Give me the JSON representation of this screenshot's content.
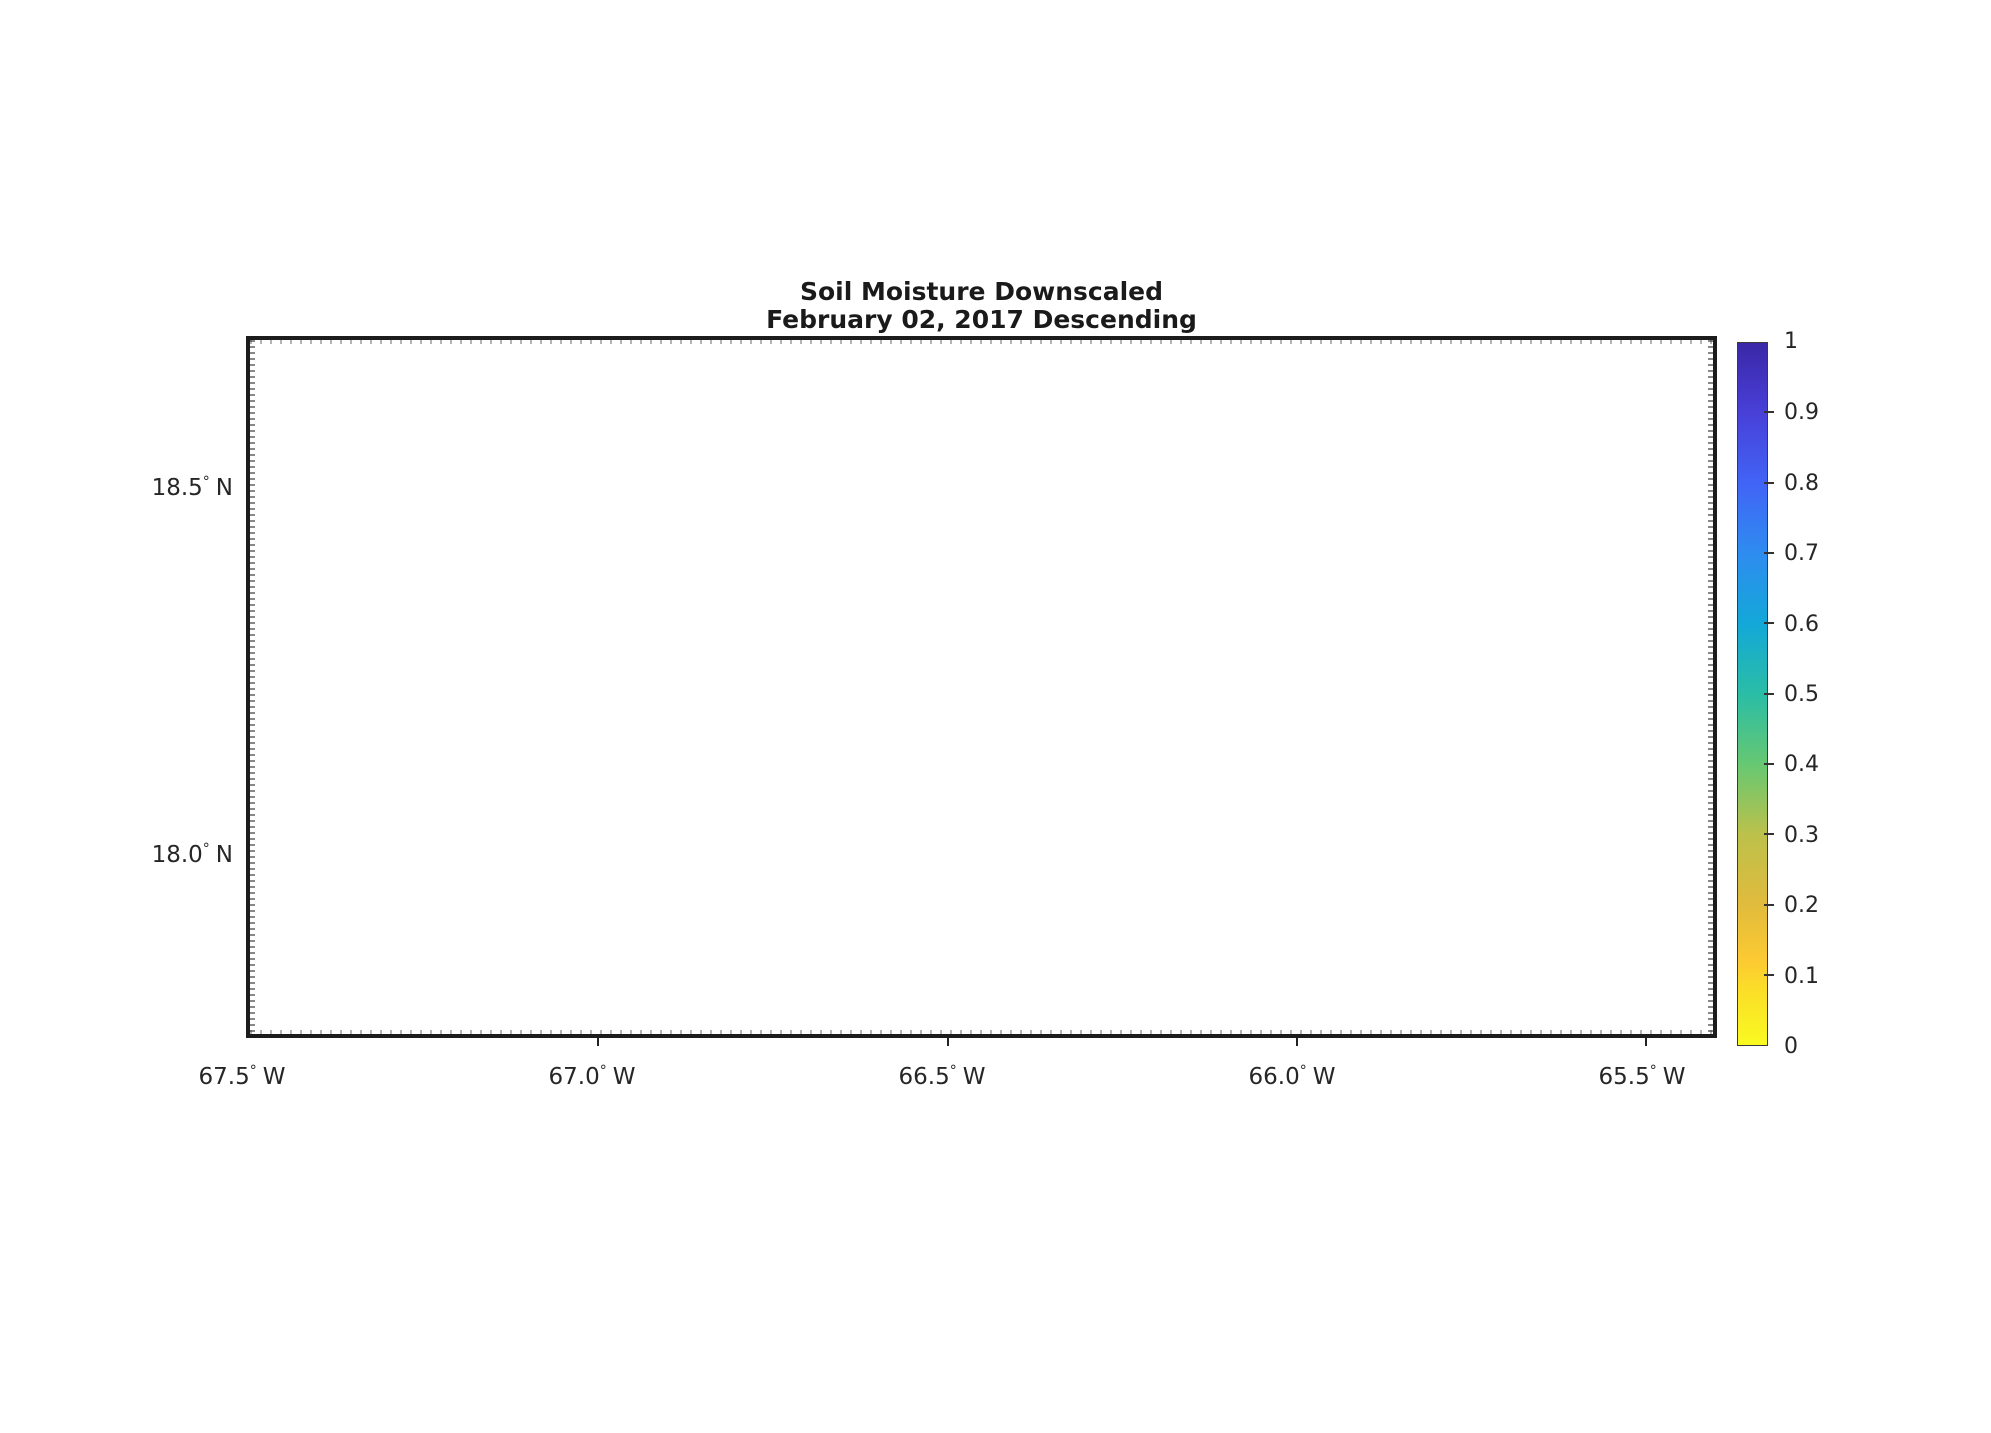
{
  "figure": {
    "title_line1": "Soil Moisture Downscaled",
    "title_line2": "February 02, 2017 Descending"
  },
  "axes": {
    "degree_symbol": "°",
    "x": {
      "ticks": [
        {
          "value": "67.5",
          "hemisphere": "W"
        },
        {
          "value": "67.0",
          "hemisphere": "W"
        },
        {
          "value": "66.5",
          "hemisphere": "W"
        },
        {
          "value": "66.0",
          "hemisphere": "W"
        },
        {
          "value": "65.5",
          "hemisphere": "W"
        }
      ]
    },
    "y": {
      "ticks": [
        {
          "value": "18.5",
          "hemisphere": "N"
        },
        {
          "value": "18.0",
          "hemisphere": "N"
        }
      ]
    }
  },
  "colorbar": {
    "min": 0,
    "max": 1,
    "tick_labels": [
      "1",
      "0.9",
      "0.8",
      "0.7",
      "0.6",
      "0.5",
      "0.4",
      "0.3",
      "0.2",
      "0.1",
      "0"
    ],
    "colormap_name": "parula reversed (0 = yellow, 1 = dark blue)",
    "gradient_stops": [
      {
        "pos": 0.0,
        "color": "#fafa21"
      },
      {
        "pos": 0.08,
        "color": "#fbdd28"
      },
      {
        "pos": 0.12,
        "color": "#fcca32"
      },
      {
        "pos": 0.2,
        "color": "#e1bb3c"
      },
      {
        "pos": 0.3,
        "color": "#bcc14b"
      },
      {
        "pos": 0.4,
        "color": "#66c872"
      },
      {
        "pos": 0.5,
        "color": "#2abda6"
      },
      {
        "pos": 0.6,
        "color": "#13a8d8"
      },
      {
        "pos": 0.7,
        "color": "#2e8cf0"
      },
      {
        "pos": 0.8,
        "color": "#4164f6"
      },
      {
        "pos": 0.9,
        "color": "#4840d8"
      },
      {
        "pos": 1.0,
        "color": "#3b27a7"
      }
    ]
  },
  "colors": {
    "background": "#ffffff",
    "island_no_data_gray": "#a9a9a9",
    "plot_border": "#1c1c1c",
    "gridline": "#cdcdcd",
    "text": "#262626",
    "swath_west_upper": "#f2c53c",
    "swath_central_green": "#aebd52",
    "swath_river_teal": "#2fbfae",
    "swath_east_central": "#f2c63b",
    "swath_east_yellow": "#f1da33",
    "swath_west_lower": "#f0e529"
  },
  "chart_data": {
    "type": "heatmap",
    "title": "Soil Moisture Downscaled",
    "subtitle": "February 02, 2017 Descending",
    "geography": "Puerto Rico (gray silhouette = island area with no retrieval)",
    "x_axis": {
      "tick_labels": [
        "67.5° W",
        "67.0° W",
        "66.5° W",
        "66.0° W",
        "65.5° W"
      ],
      "values_deg_west": [
        67.5,
        67.0,
        66.5,
        66.0,
        65.5
      ],
      "approx_limits_deg_west": [
        67.51,
        65.41
      ]
    },
    "y_axis": {
      "tick_labels": [
        "18.5° N",
        "18.0° N"
      ],
      "values_deg_north": [
        18.5,
        18.0
      ],
      "approx_limits_deg_north": [
        17.75,
        18.71
      ]
    },
    "grid": "dotted graticule at labeled ticks",
    "legend_position": "colorbar right",
    "colorbar": {
      "range": [
        0,
        1
      ],
      "ticks": [
        0,
        0.1,
        0.2,
        0.3,
        0.4,
        0.5,
        0.6,
        0.7,
        0.8,
        0.9,
        1
      ],
      "colormap": "parula reversed: 0 yellow -> 0.3 olive -> 0.5 teal -> 0.7 blue -> 1 dark indigo"
    },
    "data_swaths": [
      {
        "name": "west upper block",
        "lon_deg_w": [
          67.15,
          66.91
        ],
        "lat_deg_n": [
          18.19,
          18.42
        ],
        "approx_soil_moisture": [
          0.1,
          0.22
        ],
        "appearance": "orange-yellow with darker orange patches, few green specks"
      },
      {
        "name": "central green block",
        "lon_deg_w": [
          66.91,
          66.41
        ],
        "lat_deg_n": [
          18.19,
          18.42
        ],
        "approx_soil_moisture": [
          0.18,
          0.5
        ],
        "appearance": "olive-green upper half with teal river-like streaks (~0.45-0.55), orange-olive lower half"
      },
      {
        "name": "east-central block",
        "lon_deg_w": [
          66.41,
          66.16
        ],
        "lat_deg_n": [
          18.19,
          18.42
        ],
        "approx_soil_moisture": [
          0.1,
          0.2
        ],
        "appearance": "yellow-orange with diagonal orange swirl"
      },
      {
        "name": "east yellow block",
        "lon_deg_w": [
          66.16,
          65.9
        ],
        "lat_deg_n": [
          18.19,
          18.42
        ],
        "approx_soil_moisture": [
          0.06,
          0.14
        ],
        "appearance": "pale yellow"
      },
      {
        "name": "west lower block",
        "lon_deg_w": [
          67.15,
          66.91
        ],
        "lat_deg_n": [
          17.96,
          18.19
        ],
        "approx_soil_moisture": [
          0.03,
          0.1
        ],
        "appearance": "bright yellow, rare orange specks"
      }
    ]
  }
}
